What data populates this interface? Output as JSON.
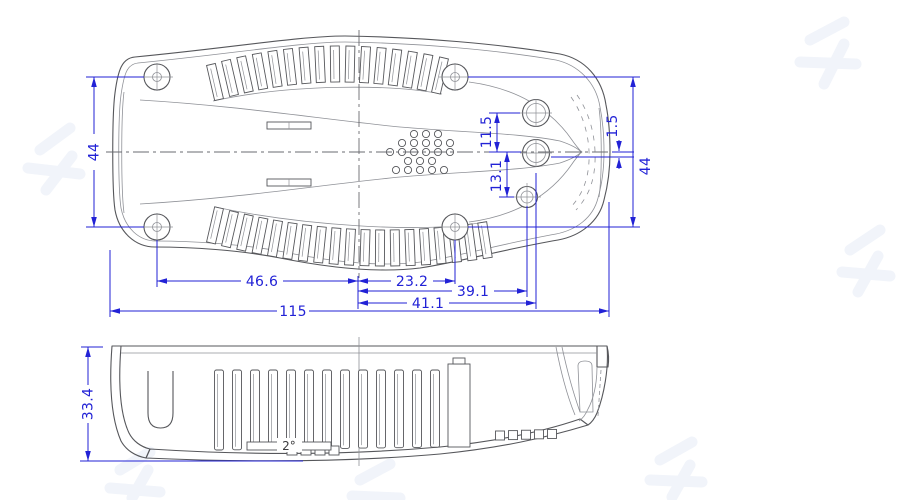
{
  "drawing": {
    "kind": "enclosure-2-view-engineering-drawing",
    "views": {
      "top_view": "bottom shell plan view",
      "side_view": "side section view"
    }
  },
  "colors": {
    "dimension_blue": "#2222d6",
    "outline_dark": "#56575b",
    "outline_light": "#8f9197",
    "hatch": "#9aa0a8",
    "background": "#ffffff",
    "watermark": "#f1f4fa"
  },
  "top_view": {
    "overall_length": "115",
    "screw_span_left": "44",
    "screw_span_right": "44",
    "screw_left_to_center": "46.6",
    "center_to_screw_right": "23.2",
    "center_to_lower_boss": "39.1",
    "center_to_boss_column": "41.1",
    "boss_upper_offset": "11.5",
    "boss_lower_offset": "13.1",
    "boss_mid_offset": "1.5"
  },
  "side_view": {
    "height": "33.4",
    "draft_angle": "2°"
  }
}
